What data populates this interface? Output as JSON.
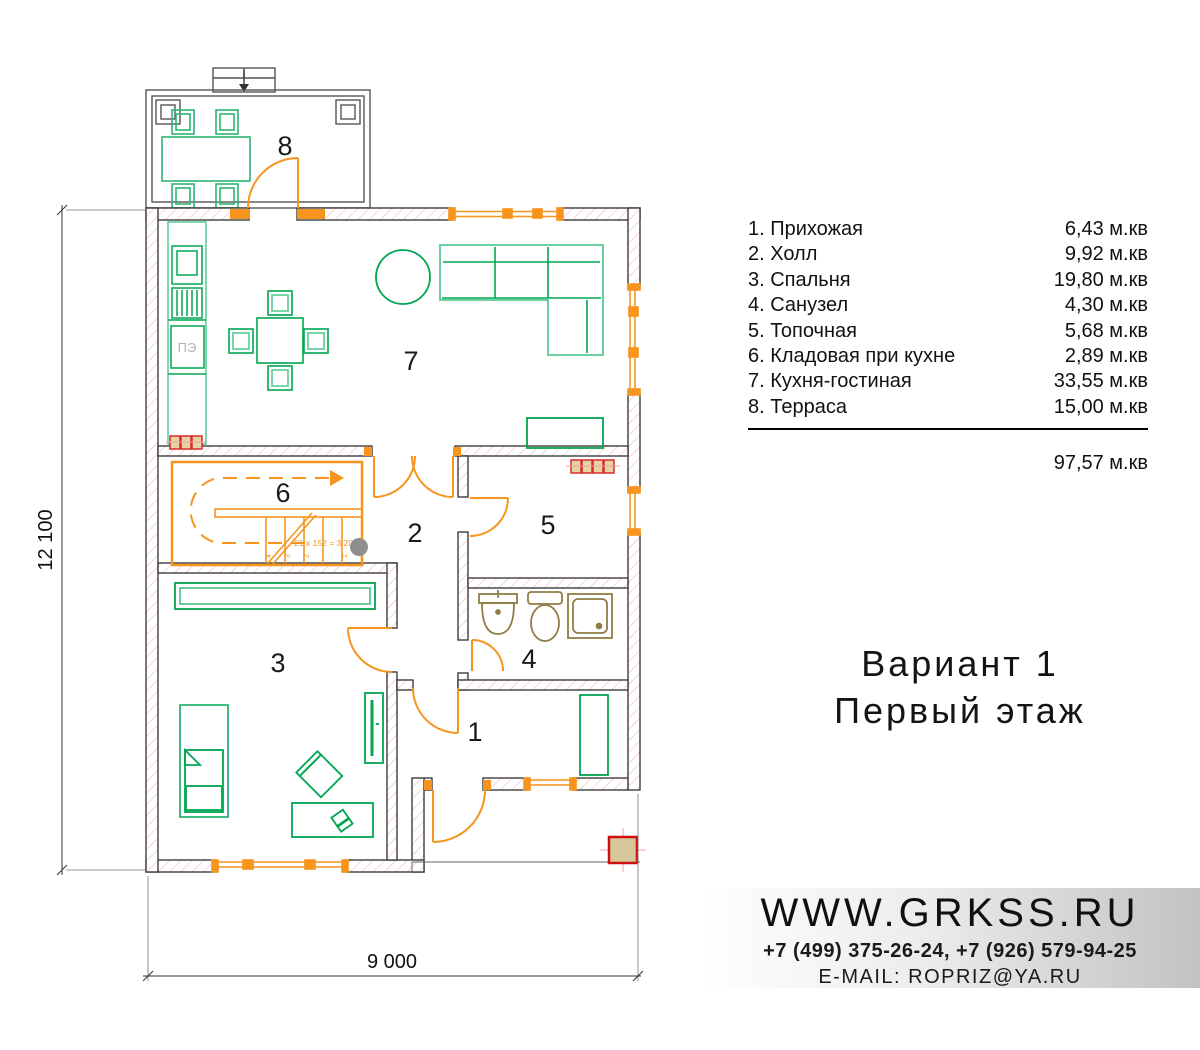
{
  "legend": {
    "rooms": [
      {
        "num": "1",
        "label": "1. Прихожая",
        "area": "6,43 м.кв"
      },
      {
        "num": "2",
        "label": "2. Холл",
        "area": "9,92 м.кв"
      },
      {
        "num": "3",
        "label": "3. Спальня",
        "area": "19,80 м.кв"
      },
      {
        "num": "4",
        "label": "4. Санузел",
        "area": "4,30 м.кв"
      },
      {
        "num": "5",
        "label": "5. Топочная",
        "area": "5,68 м.кв"
      },
      {
        "num": "6",
        "label": "6. Кладовая при кухне",
        "area": "2,89 м.кв"
      },
      {
        "num": "7",
        "label": "7. Кухня-гостиная",
        "area": "33,55 м.кв"
      },
      {
        "num": "8",
        "label": "8. Терраса",
        "area": "15,00 м.кв"
      }
    ],
    "total": "97,57 м.кв"
  },
  "plan": {
    "dim_height": "12 100",
    "dim_width": "9 000",
    "stair_note": "21 x 152 = 3 200",
    "stair_steps": [
      "4",
      "3",
      "2",
      "1"
    ],
    "stove_label": "ПЭ"
  },
  "title": {
    "line1": "Вариант 1",
    "line2": "Первый этаж"
  },
  "contacts": {
    "website": "WWW.GRKSS.RU",
    "phones": "+7 (499) 375-26-24, +7 (926) 579-94-25",
    "email": "E-MAIL: ROPRIZ@YA.RU"
  },
  "colors": {
    "furniture_green": "#00A651",
    "furniture_light_green": "#57C995",
    "openings_orange": "#F7941D",
    "radiator_red": "#D92B2B",
    "sanitary_brown": "#8F7D45",
    "wall_hatch_pink": "#F4BDBD"
  }
}
